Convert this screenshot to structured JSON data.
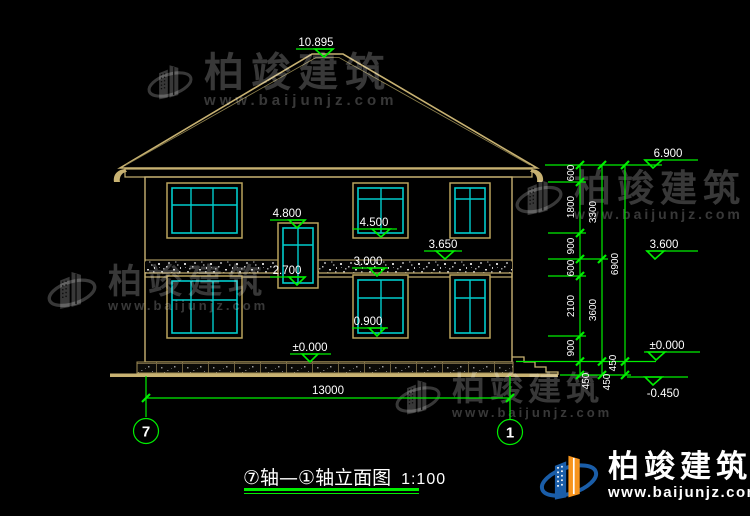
{
  "drawing": {
    "title": "⑦轴—①轴立面图",
    "scale": "1:100"
  },
  "axis_bubbles": {
    "left": "7",
    "right": "1"
  },
  "levels": {
    "ridge": "10.895",
    "eave": "6.900",
    "upper_window_head": "4.800",
    "upper_window_sill": "4.500",
    "belt_top": "3.650",
    "second_floor": "3.600",
    "lower_window_head": "3.000",
    "stair_window_sill": "2.700",
    "lower_window_sill": "0.900",
    "ground_center": "±0.000",
    "ground_right": "±0.000",
    "site_level": "-0.450"
  },
  "dimensions": {
    "total_width": "13000",
    "chain_a": [
      "600",
      "1800",
      "900",
      "600",
      "2100",
      "900",
      "450"
    ],
    "chain_b": [
      "3300",
      "3600",
      "450"
    ],
    "chain_c": [
      "6900",
      "450"
    ]
  },
  "watermark": {
    "brand": "柏竣建筑",
    "site": "www.baijunjz.com"
  },
  "footer": {
    "brand": "柏竣建筑",
    "site": "www.baijunjz.com"
  },
  "colors": {
    "background": "#000000",
    "dimension_green": "#00ef00",
    "cad_tan": "#c8b272",
    "window_cyan": "#00cccc",
    "text_white": "#ffffff",
    "logo_blue": "#1a5da8",
    "logo_orange": "#f7941d"
  }
}
